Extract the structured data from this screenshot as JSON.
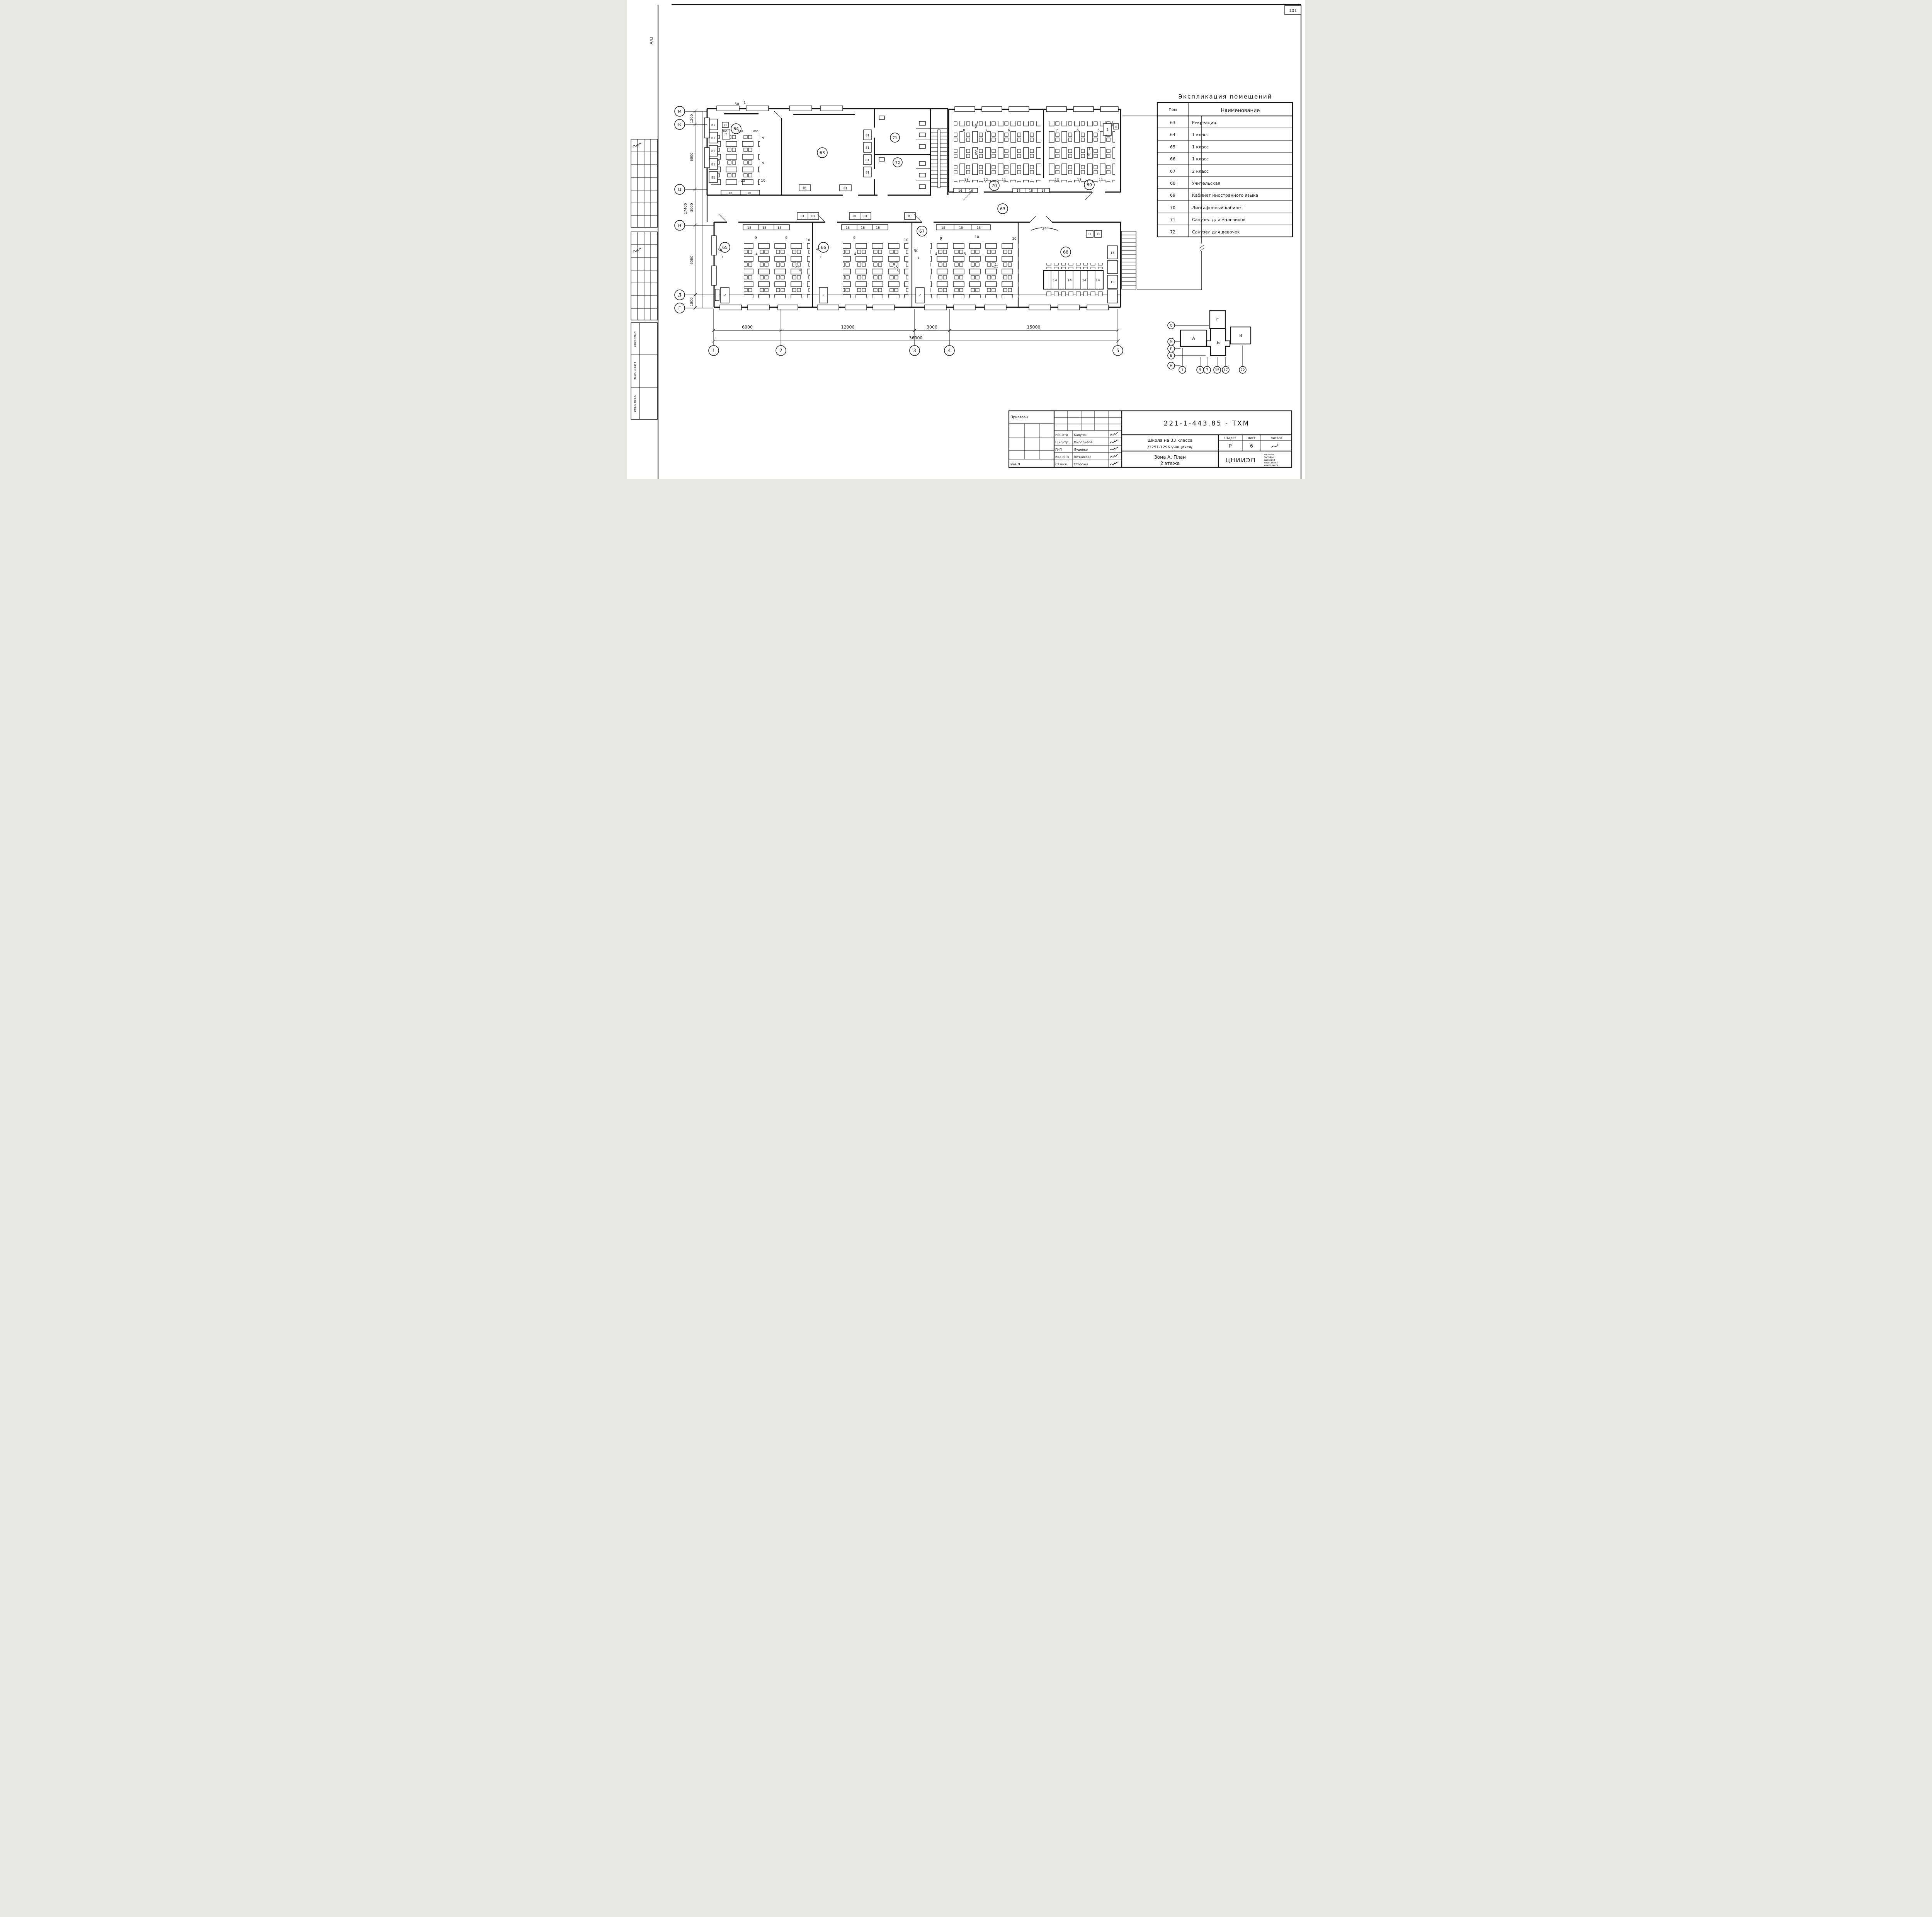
{
  "page": {
    "number": "101",
    "margin_note": "Ал.I"
  },
  "stamps": {
    "rows": [
      "Взам.инв.N",
      "Подп. и дата",
      "Инв.N подл."
    ]
  },
  "legend": {
    "title": "Экспликация помещений",
    "col_room": "Пом",
    "col_name": "Наименование",
    "rows": [
      {
        "n": "63",
        "name": "Рекреация"
      },
      {
        "n": "64",
        "name": "1 класс"
      },
      {
        "n": "65",
        "name": "1 класс"
      },
      {
        "n": "66",
        "name": "1 класс"
      },
      {
        "n": "67",
        "name": "2 класс"
      },
      {
        "n": "68",
        "name": "Учительская"
      },
      {
        "n": "69",
        "name": "Кабинет иностранного языка"
      },
      {
        "n": "70",
        "name": "Лингафонный кабинет"
      },
      {
        "n": "71",
        "name": "Санузел для мальчиков"
      },
      {
        "n": "72",
        "name": "Санузел для девочек"
      }
    ]
  },
  "grid": {
    "bottom": {
      "labels": [
        "1",
        "2",
        "3",
        "4",
        "5"
      ],
      "dims": [
        "6000",
        "12000",
        "3000",
        "15000"
      ],
      "total": "36000"
    },
    "left": {
      "labels": [
        "М",
        "К",
        "Ц",
        "Н",
        "Д",
        "Г"
      ],
      "dims": [
        "1200",
        "6000",
        "3000",
        "6000",
        "1800"
      ],
      "total": "17400"
    }
  },
  "rooms": {
    "recreation": "63",
    "r64": "64",
    "r65": "65",
    "r66": "66",
    "r67": "67",
    "r68": "68",
    "r69": "69",
    "r70": "70",
    "r71": "71",
    "r72": "72"
  },
  "furniture": {
    "desk4": "4",
    "desk5": "5",
    "rows9": "9",
    "rows10": "10",
    "mark25": "25",
    "door50": "50",
    "leaf1": "1",
    "bench81": "81",
    "cab18": "18",
    "cab16": "16",
    "table14": "14",
    "rack24": "24",
    "cab15": "15",
    "ward2": "2",
    "box13": "13",
    "box12": "12",
    "dim500": "500",
    "dim600": "600",
    "dim700": "700",
    "d8": "8",
    "d7": "7",
    "d6": "6",
    "r13": "13",
    "r12": "12",
    "r11": "11"
  },
  "keyplan": {
    "blocks": [
      "А",
      "Б",
      "В",
      "Г"
    ],
    "axes": [
      "С",
      "М",
      "Г",
      "Б",
      "Н"
    ],
    "cols": [
      "1",
      "5",
      "7",
      "15",
      "17",
      "22"
    ]
  },
  "title_block": {
    "code": "221-1-443.85 - ТХМ",
    "project_line1": "Школа на 33 класса",
    "project_line2": "/1251-1296 учащихся/",
    "zone_line1": "Зона А.  План",
    "zone_line2": "2 этажа",
    "stage_h": "Стадия",
    "sheet_h": "Лист",
    "sheets_h": "Листов",
    "stage": "Р",
    "sheet": "6",
    "org": "ЦНИИЭП",
    "org_small": [
      "торгово-",
      "бытовых",
      "зданий и",
      "туристских",
      "комплексов"
    ],
    "attach": "Привязан",
    "inv": "Инв.N",
    "staff": [
      {
        "r": "Нач.отд",
        "n": "Калугин"
      },
      {
        "r": "Н.контр",
        "n": "Миролюбов"
      },
      {
        "r": "ГИП",
        "n": "Луценко"
      },
      {
        "r": "Вед.инж",
        "n": "Печникова"
      },
      {
        "r": "Ст.инж.",
        "n": "Сторожа"
      }
    ]
  }
}
